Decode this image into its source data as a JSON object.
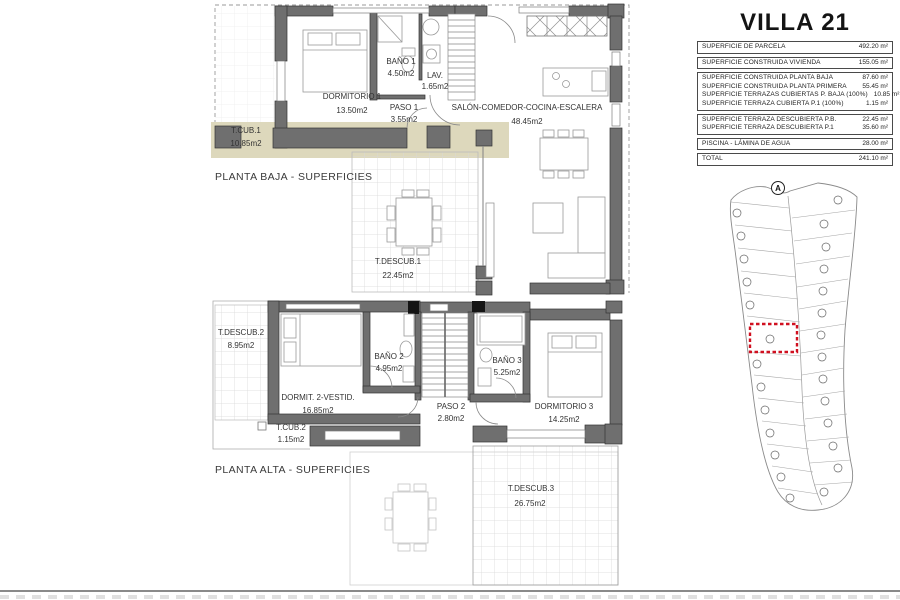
{
  "panel": {
    "title": "VILLA 21",
    "site_marker": "A",
    "table": {
      "groups": [
        {
          "rows": [
            {
              "label": "SUPERFICIE DE PARCELA",
              "value": "492.20 m²"
            }
          ]
        },
        {
          "rows": [
            {
              "label": "SUPERFICIE CONSTRUIDA VIVIENDA",
              "value": "155.05 m²"
            }
          ]
        },
        {
          "rows": [
            {
              "label": "SUPERFICIE CONSTRUIDA PLANTA BAJA",
              "value": "87.60 m²"
            },
            {
              "label": "SUPERFICIE CONSTRUIDA PLANTA PRIMERA",
              "value": "55.45 m²"
            },
            {
              "label": "SUPERFICIE TERRAZAS CUBIERTAS P. BAJA (100%)",
              "value": "10.85 m²"
            },
            {
              "label": "SUPERFICIE TERRAZA CUBIERTA P.1 (100%)",
              "value": "1.15 m²"
            }
          ]
        },
        {
          "rows": [
            {
              "label": "SUPERFICIE TERRAZA DESCUBIERTA P.B.",
              "value": "22.45 m²"
            },
            {
              "label": "SUPERFICIE TERRAZA DESCUBIERTA P.1",
              "value": "35.60 m²"
            }
          ]
        },
        {
          "rows": [
            {
              "label": "PISCINA - LÁMINA DE AGUA",
              "value": "28.00 m²"
            }
          ]
        },
        {
          "rows": [
            {
              "label": "TOTAL",
              "value": "241.10 m²"
            }
          ]
        }
      ]
    }
  },
  "plans": {
    "baja": {
      "caption": "PLANTA BAJA - SUPERFICIES",
      "rooms": [
        {
          "name": "DORMITORIO 1",
          "area": "13.50m2"
        },
        {
          "name": "BAÑO 1",
          "area": "4.50m2"
        },
        {
          "name": "LAV.",
          "area": "1.65m2"
        },
        {
          "name": "PASO 1",
          "area": "3.55m2"
        },
        {
          "name": "SALÓN-COMEDOR-COCINA-ESCALERA",
          "area": "48.45m2"
        },
        {
          "name": "T.CUB.1",
          "area": "10.85m2"
        },
        {
          "name": "T.DESCUB.1",
          "area": "22.45m2"
        }
      ]
    },
    "alta": {
      "caption": "PLANTA ALTA - SUPERFICIES",
      "rooms": [
        {
          "name": "T.DESCUB.2",
          "area": "8.95m2"
        },
        {
          "name": "DORMIT. 2-VESTID.",
          "area": "16.85m2"
        },
        {
          "name": "BAÑO 2",
          "area": "4.95m2"
        },
        {
          "name": "PASO 2",
          "area": "2.80m2"
        },
        {
          "name": "BAÑO 3",
          "area": "5.25m2"
        },
        {
          "name": "DORMITORIO 3",
          "area": "14.25m2"
        },
        {
          "name": "T.CUB.2",
          "area": "1.15m2"
        },
        {
          "name": "T.DESCUB.3",
          "area": "26.75m2"
        }
      ]
    }
  },
  "colors": {
    "highlight": "#d01020",
    "wall": "#6f6f6f",
    "terrace_edge": "#ddd8bc"
  }
}
